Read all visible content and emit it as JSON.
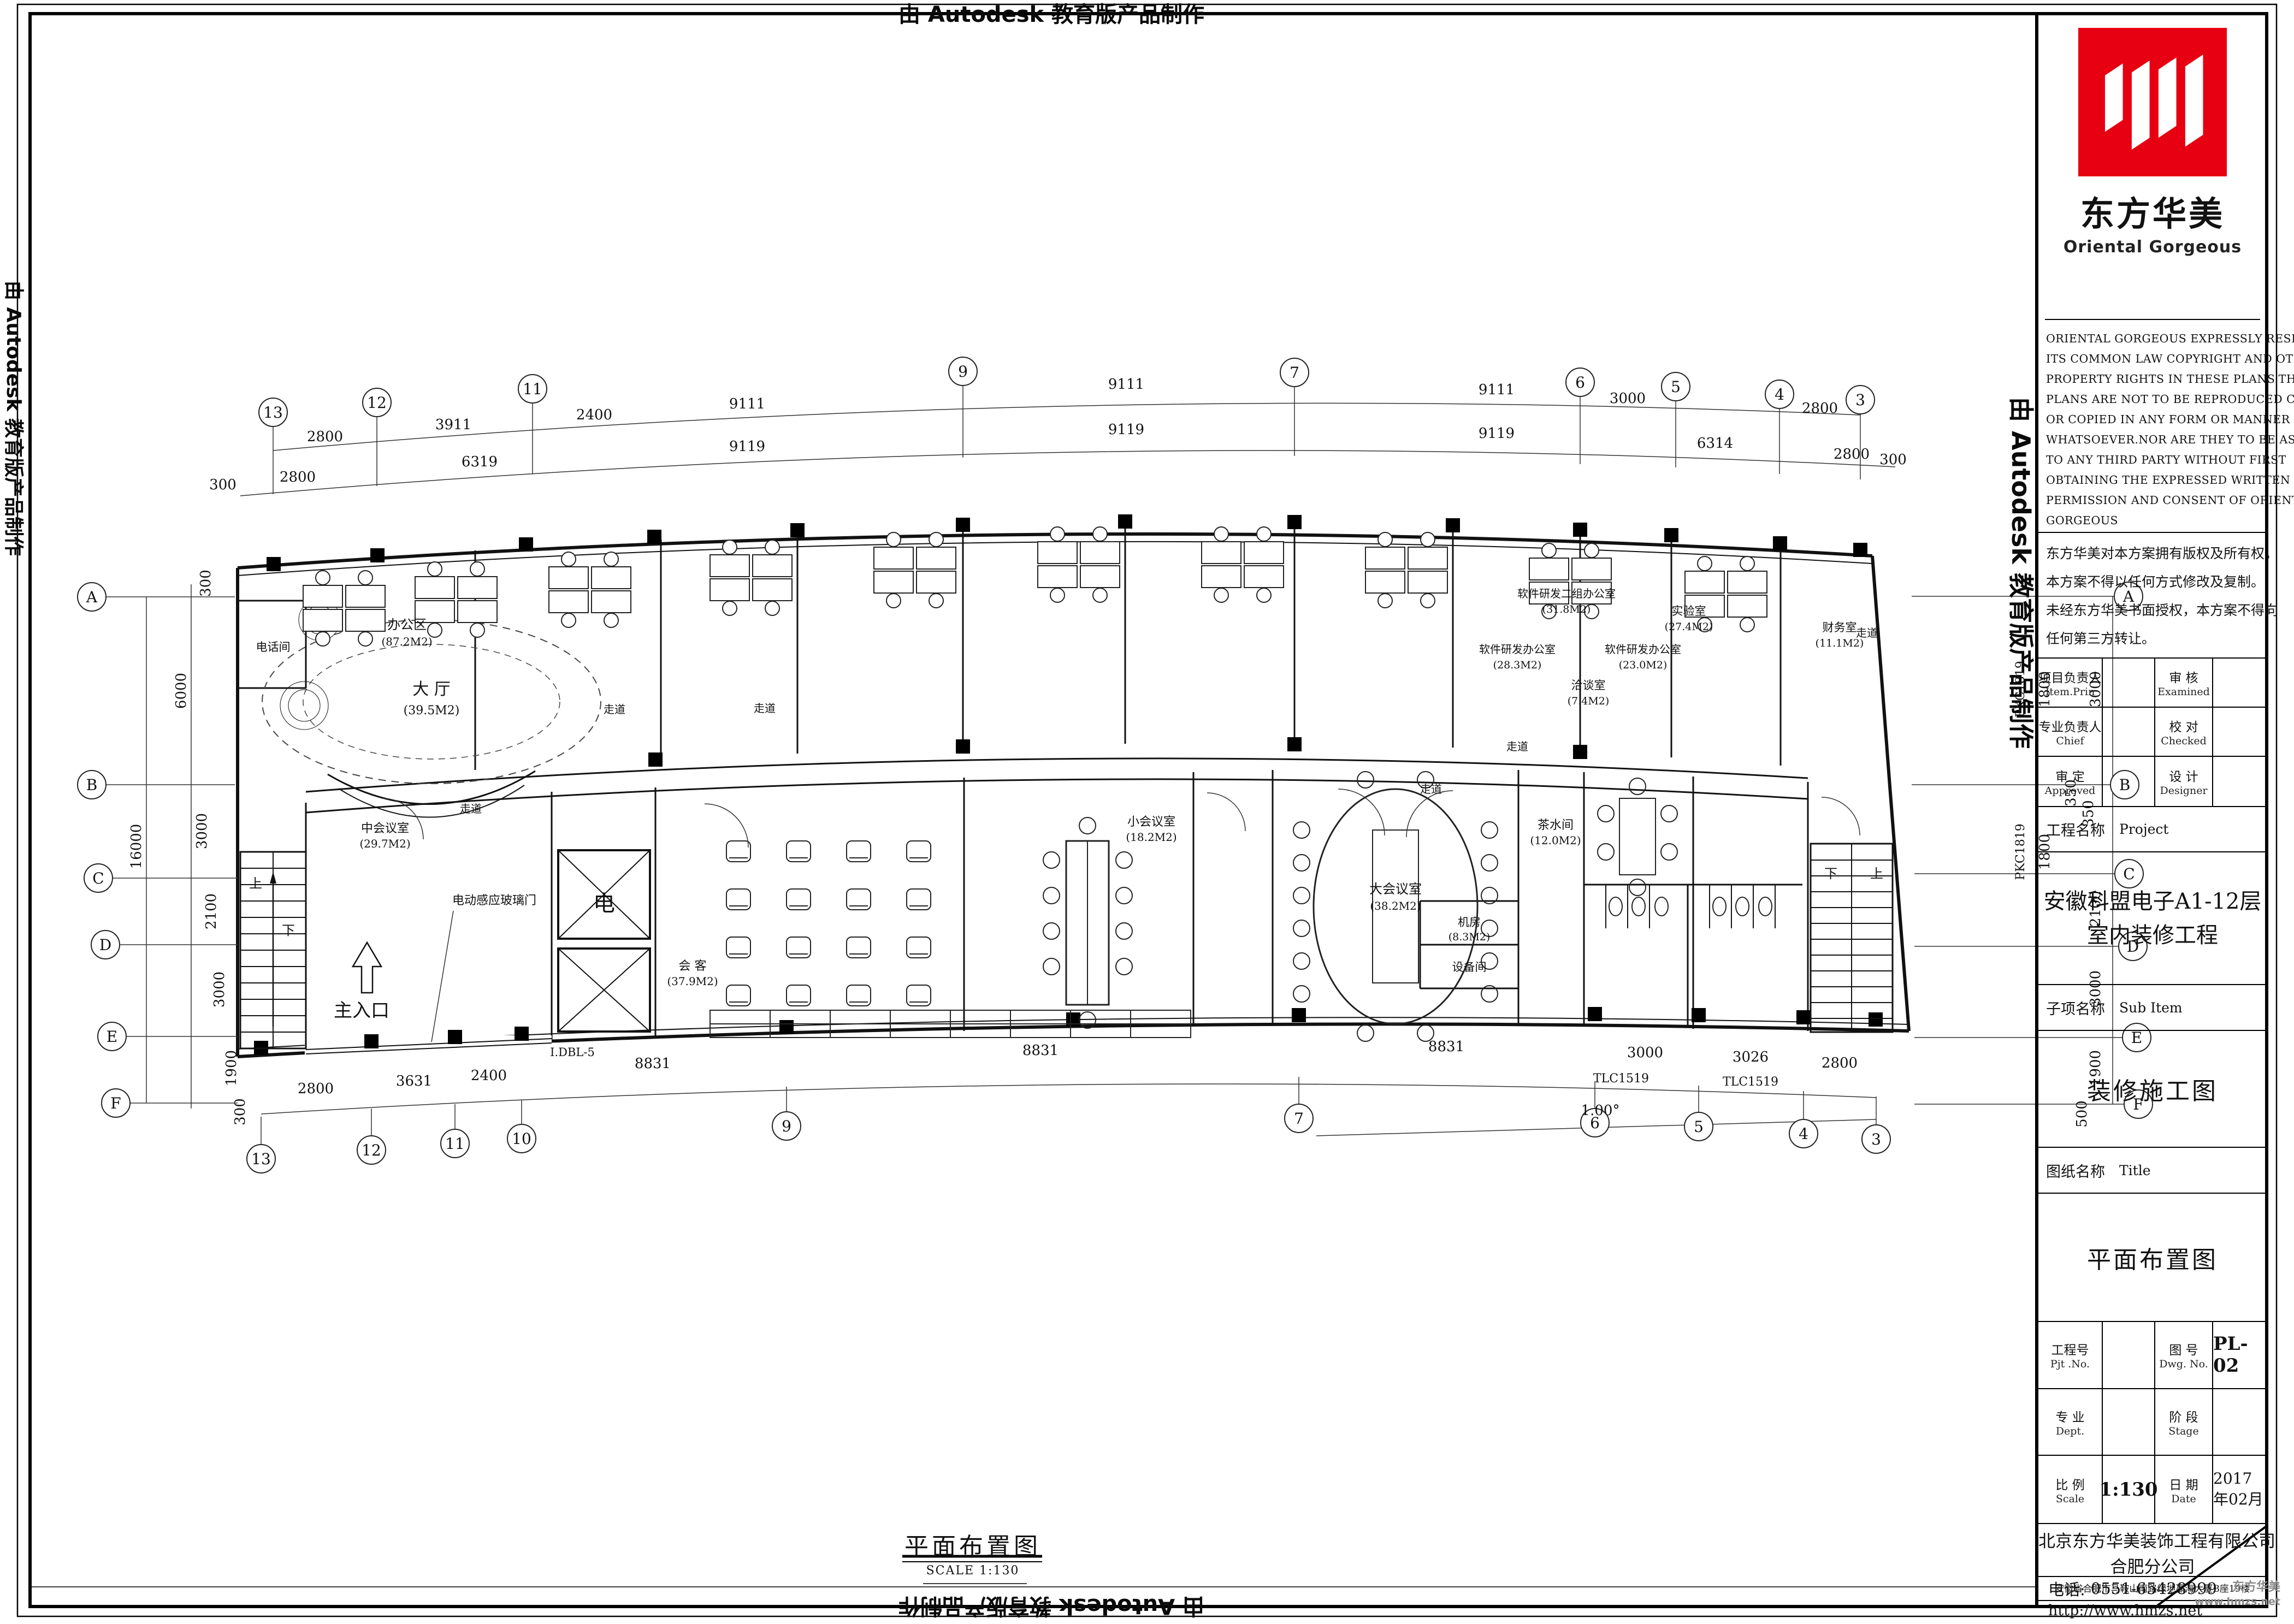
{
  "banners": {
    "autodesk_stamp": "由 Autodesk 教育版产品制作"
  },
  "drawing_title": {
    "text": "平面布置图",
    "scale_label": "SCALE",
    "scale_value": "1:130"
  },
  "corner_brand": {
    "name": "东方华美",
    "url": "www.hmzs.net"
  },
  "title_block": {
    "logo": {
      "cn": "东方华美",
      "en": "Oriental  Gorgeous",
      "color": "#e60012"
    },
    "copyright_lines": [
      "ORIENTAL GORGEOUS EXPRESSLY RESERVES",
      "ITS COMMON LAW COPYRIGHT AND OTHER",
      "PROPERTY RIGHTS IN THESE PLANS.THESE",
      "PLANS ARE NOT TO BE REPRODUCED CHANGED",
      "OR COPIED IN ANY FORM OR MANNER",
      "WHATSOEVER.NOR ARE THEY TO BE ASSIGHED",
      "TO ANY THIRD PARTY WITHOUT FIRST",
      "OBTAINING THE EXPRESSED WRITTEN",
      "PERMISSION AND CONSENT OF ORIENTAL",
      "GORGEOUS"
    ],
    "rights_cn_lines": [
      "东方华美对本方案拥有版权及所有权。",
      "本方案不得以任何方式修改及复制。",
      "未经东方华美书面授权，本方案不得向",
      "任何第三方转让。"
    ],
    "personnel": {
      "r1c1_cn": "项目负责人",
      "r1c1_en": "Item.Prin",
      "r1c3_cn": "审 核",
      "r1c3_en": "Examined",
      "r2c1_cn": "专业负责人",
      "r2c1_en": "Chief",
      "r2c3_cn": "校 对",
      "r2c3_en": "Checked",
      "r3c1_cn": "审 定",
      "r3c1_en": "Approved",
      "r3c3_cn": "设 计",
      "r3c3_en": "Designer"
    },
    "project": {
      "label_cn": "工程名称",
      "label_en": "Project",
      "name_line1": "安徽科盟电子A1-12层",
      "name_line2": "室内装修工程"
    },
    "sub_item": {
      "label_cn": "子项名称",
      "label_en": "Sub Item",
      "value": "装修施工图"
    },
    "sheet": {
      "label_cn": "图纸名称",
      "label_en": "Title",
      "value": "平面布置图"
    },
    "meta": {
      "pjt_cn": "工程号",
      "pjt_en": "Pjt .No.",
      "dwg_cn": "图 号",
      "dwg_en": "Dwg. No.",
      "dwg_no": "PL-02",
      "dept_cn": "专 业",
      "dept_en": "Dept.",
      "stage_cn": "阶 段",
      "stage_en": "Stage",
      "scale_cn": "比 例",
      "scale_en": "Scale",
      "scale_val": "1:130",
      "date_cn": "日 期",
      "date_en": "Date",
      "date_val": "2017年02月"
    },
    "company": {
      "line1": "北京东方华美装饰工程有限公司",
      "line2": "合肥分公司",
      "address": "安徽省合肥市马鞍山南路绿地赢海大厦B座19楼",
      "phone_label": "电话:",
      "phone": "0551-65428999",
      "url": "http://www.hmzs.net"
    }
  },
  "grid": {
    "top": [
      "13",
      "12",
      "11",
      "9",
      "7",
      "6",
      "5",
      "4",
      "3"
    ],
    "bottom": [
      "13",
      "12",
      "11",
      "10",
      "9",
      "7",
      "6",
      "5",
      "4",
      "3"
    ],
    "left": [
      "A",
      "B",
      "C",
      "D",
      "E",
      "F"
    ],
    "right": [
      "A",
      "B",
      "C",
      "D",
      "E",
      "F"
    ]
  },
  "dims": {
    "top1": [
      "2800",
      "3911",
      "2400",
      "9111",
      "9111",
      "9111",
      "3000",
      "2800"
    ],
    "top2": [
      "300",
      "2800",
      "6319",
      "9119",
      "9119",
      "9119",
      "6314",
      "2800",
      "300"
    ],
    "bottom": [
      "2800",
      "3631",
      "2400",
      "8831",
      "8831",
      "8831",
      "3000",
      "3026",
      "2800"
    ],
    "bottom2": "1.00°",
    "left": [
      "300",
      "6000",
      "3000",
      "16000",
      "2100",
      "3000",
      "1900",
      "300"
    ],
    "right": [
      "3000",
      "350",
      "350",
      "2100",
      "1800",
      "1800",
      "3000",
      "1900",
      "500"
    ],
    "window_marks": [
      "TLC1519",
      "TLC1519",
      "PKC1819",
      "PKC1819"
    ]
  },
  "rooms": {
    "lobby": {
      "name": "大 厅",
      "area": "(39.5M2)"
    },
    "main_entrance": "主入口",
    "glass_door": "电动感应玻璃门",
    "phone_room": "电话间",
    "elevator": "电",
    "elevator_model": "I.DBL-5",
    "stair_up": "上",
    "stair_down": "下",
    "corridor": "走道",
    "office_area": {
      "name": "办公区",
      "area": "(87.2M2)"
    },
    "finance": {
      "name": "财务室",
      "area": "(11.1M2)"
    },
    "negotiation": {
      "name": "洽谈室",
      "area": "(7.4M2)"
    },
    "lab": {
      "name": "实验室",
      "area": "(27.4M2)"
    },
    "rd_office_2": {
      "name": "软件研发二组办公室",
      "area": "(31.8M2)"
    },
    "rd_office_1": {
      "name": "软件研发办公室",
      "area": "(28.3M2)"
    },
    "rd_office_3": {
      "name": "软件研发办公室",
      "area": "(23.0M2)"
    },
    "meeting_mid": {
      "name": "中会议室",
      "area": "(29.7M2)"
    },
    "meeting_small": {
      "name": "小会议室",
      "area": "(18.2M2)"
    },
    "meeting_large": {
      "name": "大会议室",
      "area": "(38.2M2)"
    },
    "reception_area": {
      "name": "会 客",
      "area": "(37.9M2)"
    },
    "pantry": {
      "name": "茶水间",
      "area": "(12.0M2)"
    },
    "server_room": {
      "name": "机房",
      "area": "(8.3M2)"
    },
    "equipment_room": "设备间"
  }
}
